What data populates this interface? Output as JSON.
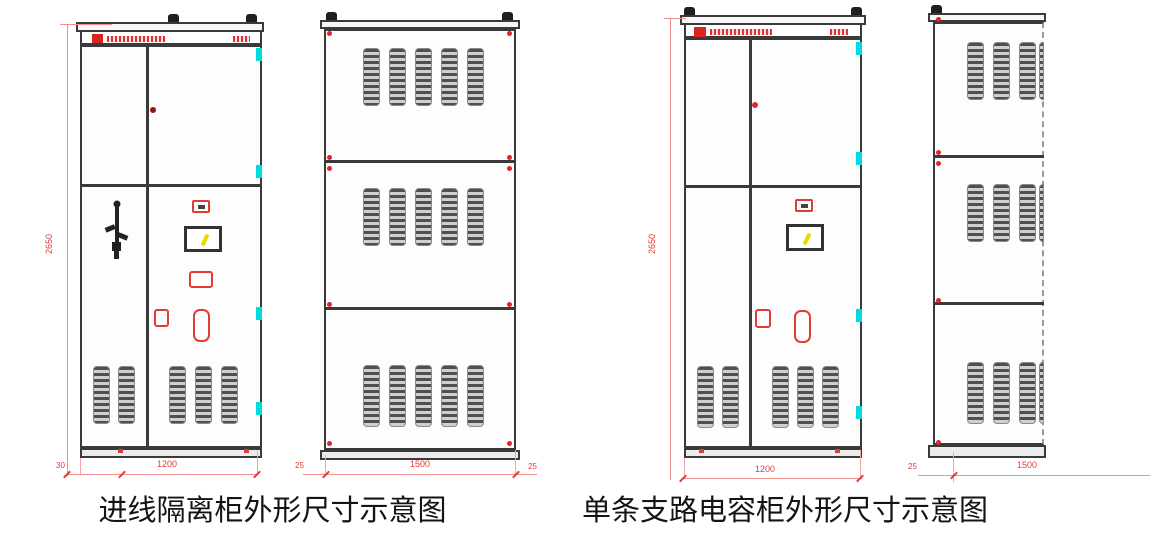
{
  "captions": {
    "left": "进线隔离柜外形尺寸示意图",
    "right": "单条支路电容柜外形尺寸示意图"
  },
  "dimensions": {
    "front_left": {
      "height": "2650",
      "width": "1200",
      "offset_left": "30"
    },
    "side_left": {
      "depth": "1500",
      "offset_left": "25",
      "offset_right": "25"
    },
    "front_right": {
      "height": "2650",
      "width": "1200"
    },
    "side_right": {
      "depth": "1500",
      "offset_left": "25"
    }
  },
  "colors": {
    "outline": "#3a3a3a",
    "dimension_line": "#f09090",
    "dimension_text": "#e23b36",
    "hinge_cyan": "#00dcdc",
    "indicator_yellow": "#efd400",
    "dot_dark_red": "#8e1616",
    "dot_bright_red": "#e3242b",
    "widget_red": "#e23b36"
  }
}
